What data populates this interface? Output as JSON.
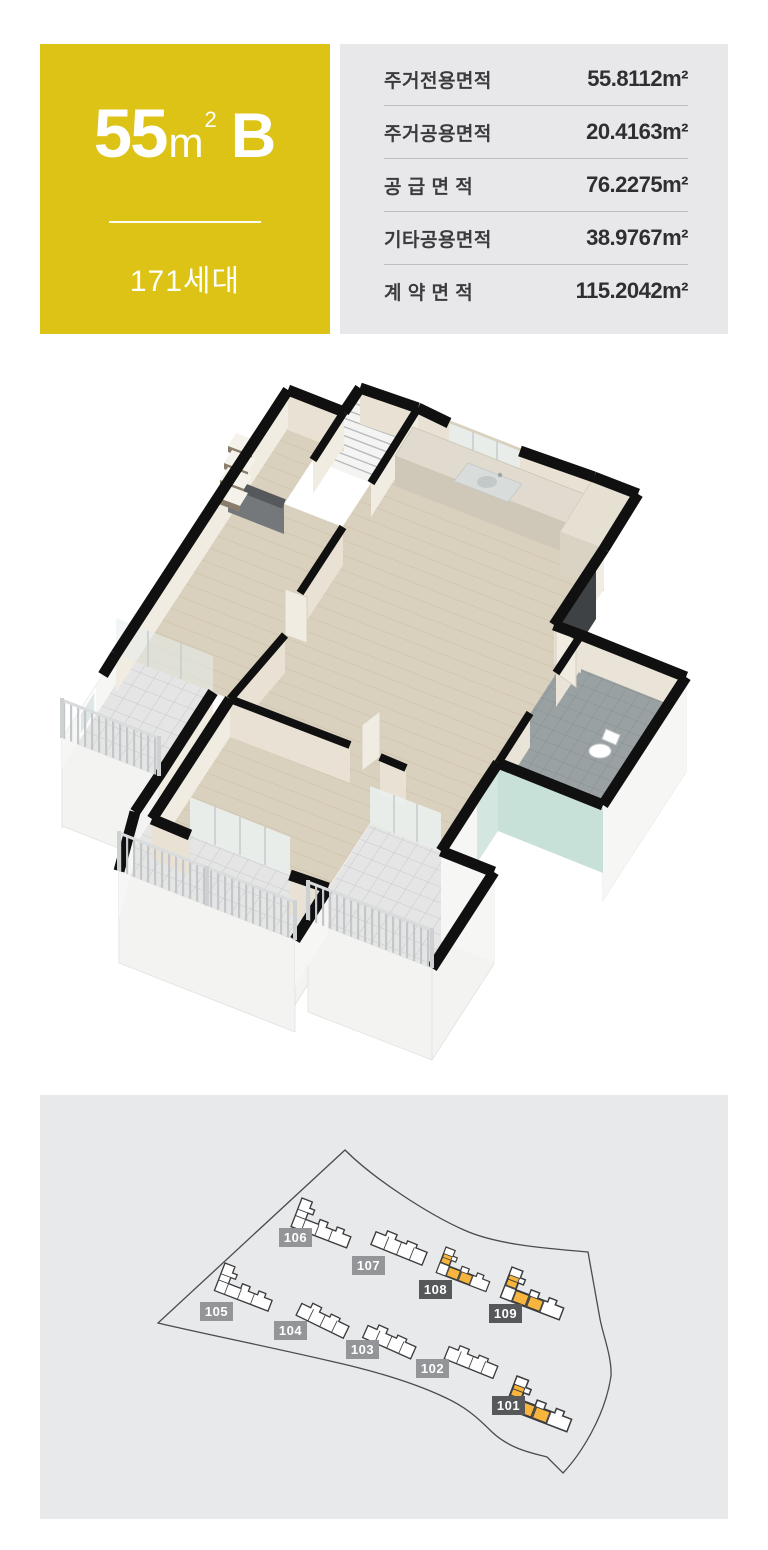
{
  "colors": {
    "badge-bg": "#DCC316",
    "table-bg": "#E8E8EA",
    "table-sep": "#BFBFC1",
    "text-dark": "#3B3B3D",
    "panel-bg": "#E8E9EB",
    "label-dark": "#57585A",
    "label-light": "#939598",
    "bld-highlight": "#F7B53E",
    "wall": "#101010",
    "cream": "#E9E2D4",
    "cream-l": "#F1ECE1",
    "outer": "#F6F6F4",
    "wood": "#D9D0BD",
    "balc": "#E4E5E4",
    "bath": "#9AA1A3",
    "teal": "#C7E0D8",
    "teal-l": "#D4E6E0",
    "plinth": "#F3F3F1",
    "rail": "#C3C7C9",
    "tv": "#3F4244",
    "gray-band": "#56595C"
  },
  "header": {
    "unit_badge": {
      "area_number": "55",
      "area_unit": "m",
      "area_sup": "2",
      "type_letter": "B",
      "household_count": "171세대"
    },
    "area_table": {
      "rows": [
        {
          "label": "주거전용면적",
          "value": "55.8112",
          "unit": "m²"
        },
        {
          "label": "주거공용면적",
          "value": "20.4163",
          "unit": "m²"
        },
        {
          "label": "공 급 면 적",
          "value": "76.2275",
          "unit": "m²"
        },
        {
          "label": "기타공용면적",
          "value": "38.9767",
          "unit": "m²"
        },
        {
          "label": "계 약 면 적",
          "value": "115.2042",
          "unit": "m²"
        }
      ]
    }
  },
  "floor_plan": {
    "description": "3D isometric cutaway rendering of the 55㎡ B unit: living room, bedrooms, dress room, kitchen with sink counter, bathroom with toilet, mint accent walls and balconies with railings"
  },
  "site_map": {
    "buildings": [
      {
        "id": "101",
        "label": "101",
        "shape": "L",
        "highlighted": true,
        "x": 477,
        "y": 281,
        "rot": 21,
        "scale": 0.95,
        "lx": 452,
        "ly": 301
      },
      {
        "id": "102",
        "label": "102",
        "shape": "bar",
        "highlighted": false,
        "x": 411,
        "y": 247,
        "rot": 22,
        "scale": 0.82,
        "lx": 376,
        "ly": 264
      },
      {
        "id": "103",
        "label": "103",
        "shape": "bar",
        "highlighted": false,
        "x": 330,
        "y": 226,
        "rot": 24,
        "scale": 0.82,
        "lx": 306,
        "ly": 245
      },
      {
        "id": "104",
        "label": "104",
        "shape": "bar",
        "highlighted": false,
        "x": 264,
        "y": 204,
        "rot": 26,
        "scale": 0.82,
        "lx": 234,
        "ly": 226
      },
      {
        "id": "105",
        "label": "105",
        "shape": "L",
        "highlighted": false,
        "x": 185,
        "y": 168,
        "rot": 21,
        "scale": 0.82,
        "lx": 160,
        "ly": 207
      },
      {
        "id": "106",
        "label": "106",
        "shape": "L",
        "highlighted": false,
        "x": 262,
        "y": 103,
        "rot": 21,
        "scale": 0.85,
        "lx": 239,
        "ly": 133
      },
      {
        "id": "107",
        "label": "107",
        "shape": "bar",
        "highlighted": false,
        "x": 338,
        "y": 132,
        "rot": 22,
        "scale": 0.86,
        "lx": 312,
        "ly": 161
      },
      {
        "id": "108",
        "label": "108",
        "shape": "L",
        "highlighted": true,
        "x": 406,
        "y": 152,
        "rot": 21,
        "scale": 0.76,
        "lx": 379,
        "ly": 185
      },
      {
        "id": "109",
        "label": "109",
        "shape": "L",
        "highlighted": true,
        "x": 472,
        "y": 172,
        "rot": 21,
        "scale": 0.9,
        "lx": 449,
        "ly": 209
      }
    ]
  }
}
